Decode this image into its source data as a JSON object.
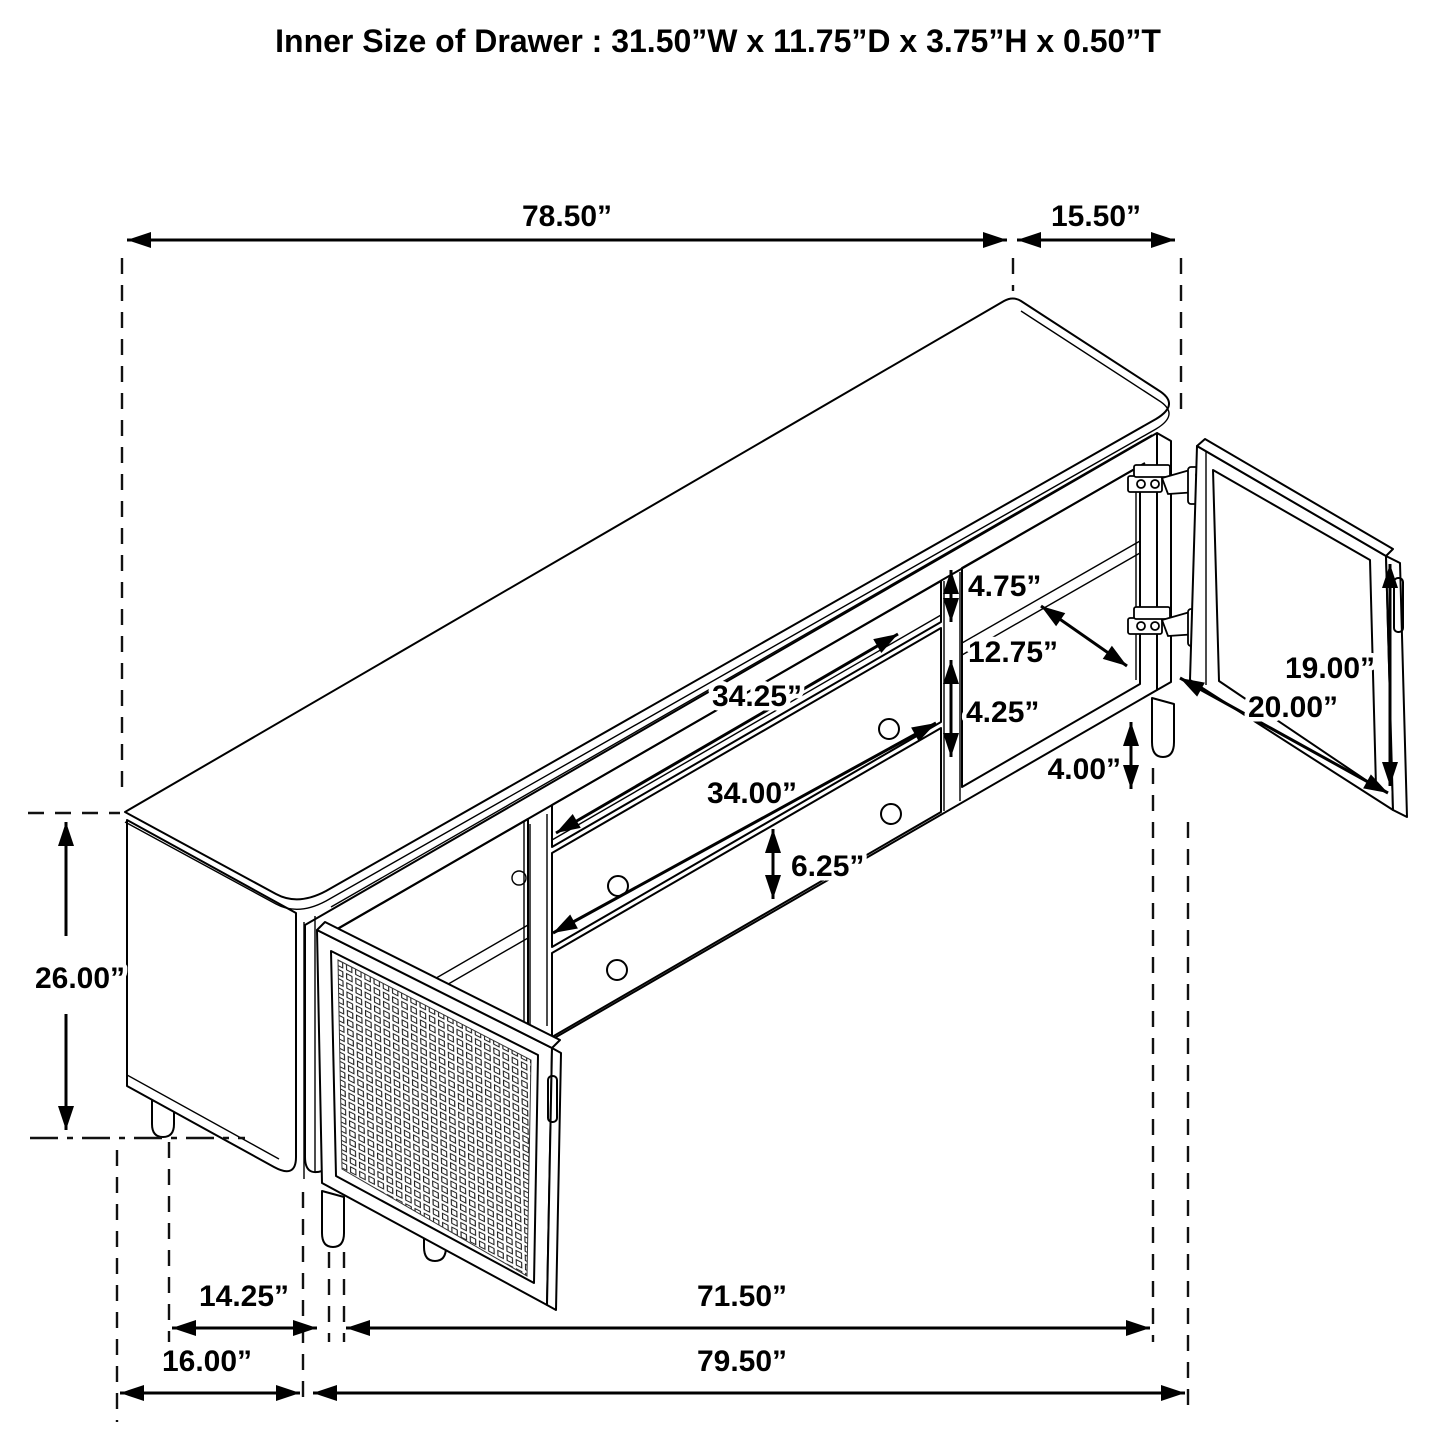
{
  "title": "Inner Size of Drawer : 31.50”W x 11.75”D x 3.75”H x 0.50”T",
  "diagram": {
    "type": "furniture-dimension-diagram",
    "subject": "TV console sideboard, isometric line drawing with cane door open left and hinged door open right",
    "units": "inches",
    "dimensions": {
      "top_width": "78.50”",
      "top_depth": "15.50”",
      "overall_height": "26.00”",
      "open_shelf_height": "4.75”",
      "right_shelf_width": "12.75”",
      "right_opening_height": "4.25”",
      "leg_height": "4.00”",
      "right_door_height": "19.00”",
      "right_door_width": "20.00”",
      "upper_opening_width": "34.25”",
      "drawer_width": "34.00”",
      "lower_drawer_height": "6.25”",
      "left_leg_offset": "14.25”",
      "base_span": "71.50”",
      "left_depth": "16.00”",
      "overall_width": "79.50”"
    }
  }
}
